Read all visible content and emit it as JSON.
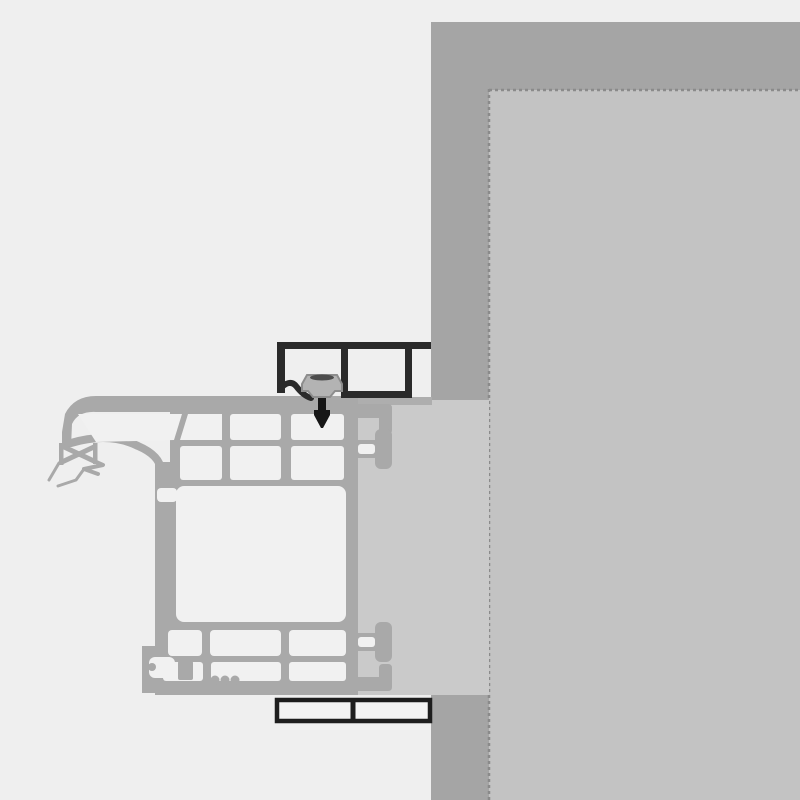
{
  "diagram": {
    "kind": "window-frame-installation-cross-section",
    "components": {
      "exterior_wall": "masonry wall band",
      "interior_wall_surface": "wall reveal surface",
      "insulation_filler": "joint filler block",
      "frame_profile": "multi-chamber window frame profile",
      "gasket": "flexible sealing gasket",
      "mounting_bracket": "dark mounting bracket profile",
      "anchor_clamp": "anchor clamp with screw",
      "trim_strip": "dark trim strip"
    }
  },
  "colors": {
    "background": "#efefef",
    "wall": "#a5a5a5",
    "wall_inner": "#c3c3c3",
    "wall_border": "#8a8a8a",
    "filler": "#cacaca",
    "frame": "#a9a9a9",
    "frame_flange": "#aeaeae",
    "chamber": "#f1f1f1",
    "bracket": "#2a2a2a",
    "clamp_fill": "#b3b3b3",
    "clamp_stroke": "#8d8d8d",
    "clamp_hatch": "#4d4d4d",
    "screw": "#161616",
    "strip_border": "#1e1e1e",
    "strip_cell": "#f4f4f4"
  }
}
